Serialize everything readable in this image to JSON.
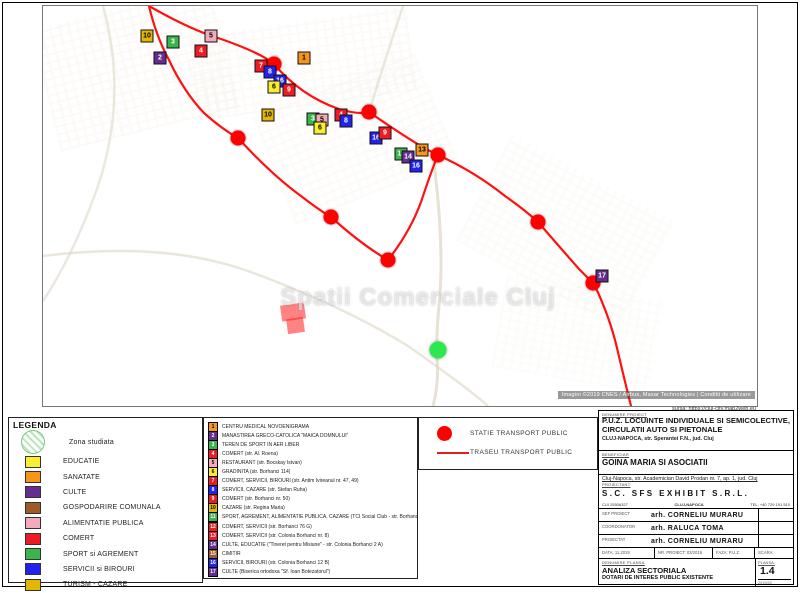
{
  "map": {
    "watermark": "Spatii Comerciale Cluj",
    "attribution": "Imagini ©2019 CNES / Airbus, Maxar Technologies | Conditii de utilizare",
    "source_note": "sursa: https://cluj-city.map2web.eu",
    "route_color": "#ff1111",
    "routes": {
      "top": "M106,0 Q148,24 178,33 Q218,47 231,58 Q258,90 296,103 Q316,109 326,106 Q362,131 383,143 L395,149",
      "loop": "M106,0 Q113,30 126,54 Q141,86 161,107 Q179,123 195,132 Q229,169 258,190 Q276,204 288,211 Q319,239 345,254 Q367,226 378,196 Q389,163 395,149",
      "cont": "M395,149 Q432,166 462,190 Q482,204 495,216 Q521,246 536,263 Q549,276 552,280 Q567,312 574,342 Q582,376 588,400"
    },
    "roads": [
      "M390,150 Q402,240 396,300 Q393,330 394,352 Q396,378 390,400",
      "M0,250 Q120,235 205,265 Q300,300 365,340 Q425,382 445,400",
      "M60,0 Q85,90 55,180 Q30,250 0,295",
      "M326,106 Q340,60 360,0"
    ],
    "markers": [
      {
        "x": 104,
        "y": 30,
        "n": "10",
        "color": "#e3b505"
      },
      {
        "x": 130,
        "y": 36,
        "n": "3",
        "color": "#39b54a"
      },
      {
        "x": 117,
        "y": 52,
        "n": "2",
        "color": "#662d91"
      },
      {
        "x": 168,
        "y": 30,
        "n": "5",
        "color": "#f5aabc"
      },
      {
        "x": 158,
        "y": 45,
        "n": "4",
        "color": "#ed1c24"
      },
      {
        "x": 218,
        "y": 60,
        "n": "7",
        "color": "#ed1c24"
      },
      {
        "x": 227,
        "y": 66,
        "n": "8",
        "color": "#2222ee"
      },
      {
        "x": 237,
        "y": 75,
        "n": "16",
        "color": "#2222ee"
      },
      {
        "x": 231,
        "y": 81,
        "n": "6",
        "color": "#f9ed32"
      },
      {
        "x": 246,
        "y": 84,
        "n": "9",
        "color": "#ed1c24"
      },
      {
        "x": 261,
        "y": 52,
        "n": "1",
        "color": "#f7941d"
      },
      {
        "x": 225,
        "y": 109,
        "n": "10",
        "color": "#e3b505"
      },
      {
        "x": 270,
        "y": 113,
        "n": "3",
        "color": "#39b54a"
      },
      {
        "x": 279,
        "y": 114,
        "n": "5",
        "color": "#f5aabc"
      },
      {
        "x": 277,
        "y": 122,
        "n": "6",
        "color": "#f9ed32"
      },
      {
        "x": 298,
        "y": 109,
        "n": "4",
        "color": "#ed1c24"
      },
      {
        "x": 303,
        "y": 115,
        "n": "8",
        "color": "#2222ee"
      },
      {
        "x": 333,
        "y": 132,
        "n": "16",
        "color": "#2222ee"
      },
      {
        "x": 342,
        "y": 127,
        "n": "9",
        "color": "#ed1c24"
      },
      {
        "x": 358,
        "y": 148,
        "n": "11",
        "color": "#39b54a"
      },
      {
        "x": 365,
        "y": 151,
        "n": "14",
        "color": "#662d91"
      },
      {
        "x": 379,
        "y": 144,
        "n": "13",
        "color": "#f7941d"
      },
      {
        "x": 373,
        "y": 160,
        "n": "16",
        "color": "#2222ee"
      },
      {
        "x": 559,
        "y": 270,
        "n": "17",
        "color": "#662d91"
      }
    ],
    "stations": [
      {
        "x": 231,
        "y": 58
      },
      {
        "x": 326,
        "y": 106
      },
      {
        "x": 395,
        "y": 149
      },
      {
        "x": 495,
        "y": 216
      },
      {
        "x": 550,
        "y": 277
      },
      {
        "x": 195,
        "y": 132
      },
      {
        "x": 288,
        "y": 211
      },
      {
        "x": 345,
        "y": 254
      }
    ],
    "study_marker": {
      "x": 395,
      "y": 344
    },
    "highlight_parcels": [
      {
        "x": 238,
        "y": 298,
        "w": 24,
        "h": 16
      },
      {
        "x": 244,
        "y": 312,
        "w": 17,
        "h": 15
      }
    ]
  },
  "legend": {
    "title": "LEGENDA",
    "zone_label": "Zona studiata",
    "items": [
      {
        "label": "EDUCATIE",
        "color": "#f9ed32"
      },
      {
        "label": "SANATATE",
        "color": "#f7941d"
      },
      {
        "label": "CULTE",
        "color": "#662d91"
      },
      {
        "label": "GOSPODARIRE COMUNALA",
        "color": "#9e5b28"
      },
      {
        "label": "ALIMENTATIE PUBLICA",
        "color": "#f5aabc"
      },
      {
        "label": "COMERT",
        "color": "#ed1c24"
      },
      {
        "label": "SPORT si AGREMENT",
        "color": "#39b54a"
      },
      {
        "label": "SERVICII si BIROURI",
        "color": "#2222ee"
      },
      {
        "label": "TURISM - CAZARE",
        "color": "#e3b505"
      }
    ]
  },
  "poi_list": {
    "items": [
      {
        "n": "1",
        "color": "#f7941d",
        "text": "CENTRU MEDICAL NOVOENIGRAMA"
      },
      {
        "n": "2",
        "color": "#662d91",
        "text": "MANASTIREA GRECO-CATOLICA \"MAICA DOMNULUI\""
      },
      {
        "n": "3",
        "color": "#39b54a",
        "text": "TEREN DE SPORT IN AER LIBER"
      },
      {
        "n": "4",
        "color": "#ed1c24",
        "text": "COMERT (str. Al. Roena)"
      },
      {
        "n": "5",
        "color": "#f5aabc",
        "text": "RESTAURANT (str. Bocskay Istvan)"
      },
      {
        "n": "6",
        "color": "#f9ed32",
        "text": "GRADINITA (str. Borhanci 114)"
      },
      {
        "n": "7",
        "color": "#ed1c24",
        "text": "COMERT, SERVICII, BIROURI (str. Antim Ivireanul nr. 47, 49)"
      },
      {
        "n": "8",
        "color": "#2222ee",
        "text": "SERVICII, CAZARE (str. Stefan Ruha)"
      },
      {
        "n": "9",
        "color": "#ed1c24",
        "text": "COMERT (str. Borhanci nr. 50)"
      },
      {
        "n": "10",
        "color": "#e3b505",
        "text": "CAZARE (str. Regina Maria)"
      },
      {
        "n": "11",
        "color": "#39b54a",
        "text": "SPORT, AGREMENT, ALIMENTATIE PUBLICA, CAZARE (TCI Social Club - str. Borhanci 76 F)"
      },
      {
        "n": "12",
        "color": "#ed1c24",
        "text": "COMERT, SERVICII (str. Borhanci 76 G)"
      },
      {
        "n": "13",
        "color": "#ed1c24",
        "text": "COMERT, SERVICII (str. Colonia Borhanci nr. 8)"
      },
      {
        "n": "14",
        "color": "#662d91",
        "text": "CULTE, EDUCATIE (\"Tineret pentru Misiune\" - str. Colonia Borhanci 2 A)"
      },
      {
        "n": "15",
        "color": "#9e5b28",
        "text": "CIMITIR"
      },
      {
        "n": "16",
        "color": "#2222ee",
        "text": "SERVICII, BIROURI (str. Colonia Borhanci 12 B)"
      },
      {
        "n": "17",
        "color": "#662d91",
        "text": "CULTE (Biserica ortodoxa \"Sf. Ioan Botezatorul\")"
      }
    ]
  },
  "transport_legend": {
    "station_label": "STATIE TRANSPORT PUBLIC",
    "route_label": "TRASEU TRANSPORT PUBLIC"
  },
  "titleblock": {
    "project_label": "DENUMIRE PROIECT",
    "project_title": "P.U.Z. LOCUINTE INDIVIDUALE SI SEMICOLECTIVE, CIRCULATII AUTO SI PIETONALE",
    "project_address": "CLUJ-NAPOCA, str. Sperantei F.N., jud. Cluj",
    "client_label": "BENEFICIAR",
    "client_name": "GOINA MARIA SI ASOCIATII",
    "client_address": "Cluj-Napoca, str. Academician David Prodan nr. 7, ap. 1, jud. Cluj",
    "designer_label": "PROIECTANT",
    "designer_name": "S.C. SFS EXHIBIT S.R.L.",
    "designer_cui": "CUI 25506327",
    "designer_city": "CLUJ-NAPOCA",
    "designer_tel": "TEL: +40 729 191 510",
    "people": [
      {
        "role": "SEF PROIECT",
        "name": "arh. CORNELIU MURARU"
      },
      {
        "role": "COORDONATOR",
        "name": "arh. RALUCA TOMA"
      },
      {
        "role": "PROIECTAT",
        "name": "arh. CORNELIU MURARU"
      }
    ],
    "meta": {
      "data": "DATA: 11.2019",
      "nr_proiect": "NR. PROIECT: 03/2019",
      "faza": "FAZA: P.U.Z.",
      "scara": "SCARA:"
    },
    "sheet_label": "DENUMIRE PLANSA",
    "sheet_title1": "ANALIZA SECTORIALA",
    "sheet_title2": "DOTARI DE INTERES PUBLIC EXISTENTE",
    "plansa_label": "PLANSA:",
    "plansa_no": "1.4",
    "plansa_sub": "2019/20"
  }
}
